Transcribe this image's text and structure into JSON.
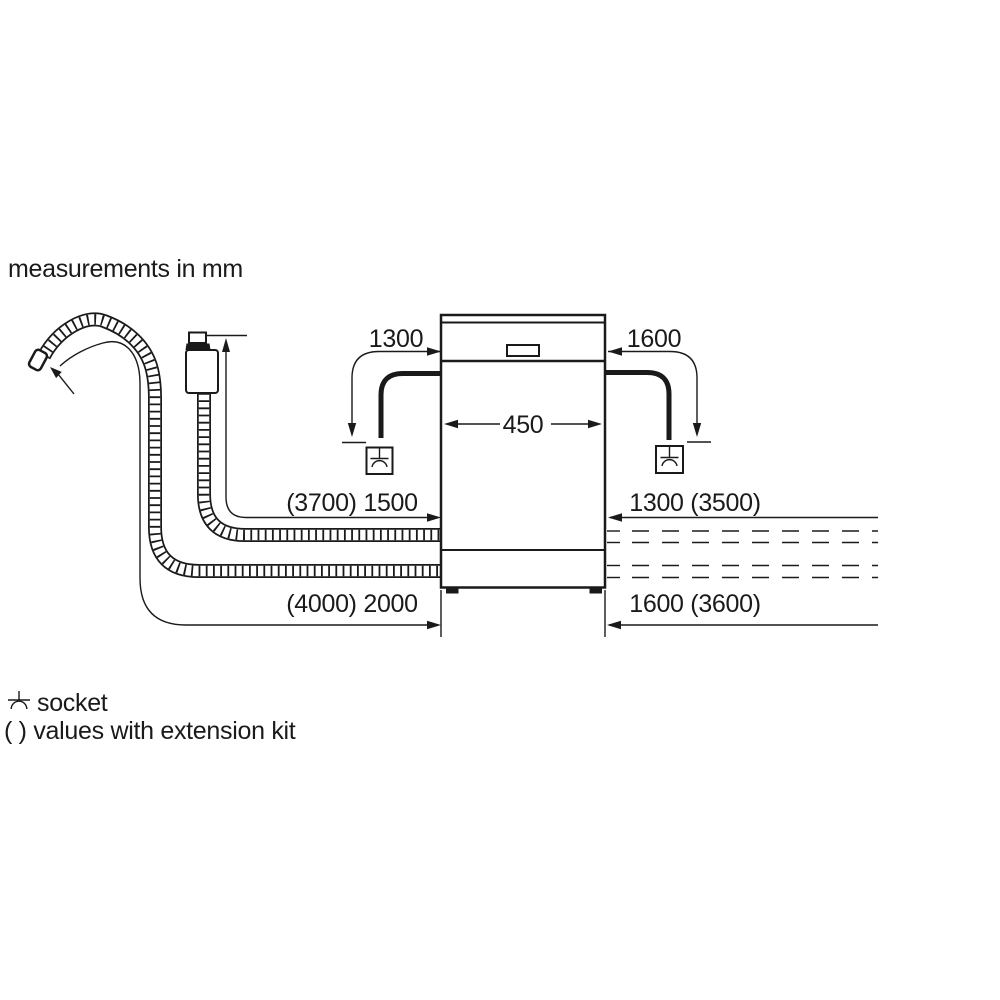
{
  "title": "measurements in mm",
  "dimensions": {
    "cord_left": "1300",
    "cord_right": "1600",
    "appliance_width": "450",
    "supply_hose_left": "(3700) 1500",
    "supply_hose_right": "1300 (3500)",
    "drain_hose_left": "(4000) 2000",
    "drain_hose_right": "1600 (3600)"
  },
  "legend": {
    "socket_label": "socket",
    "extension_note": "( ) values with extension kit"
  },
  "colors": {
    "ink": "#1a1a1a",
    "background": "#ffffff"
  }
}
